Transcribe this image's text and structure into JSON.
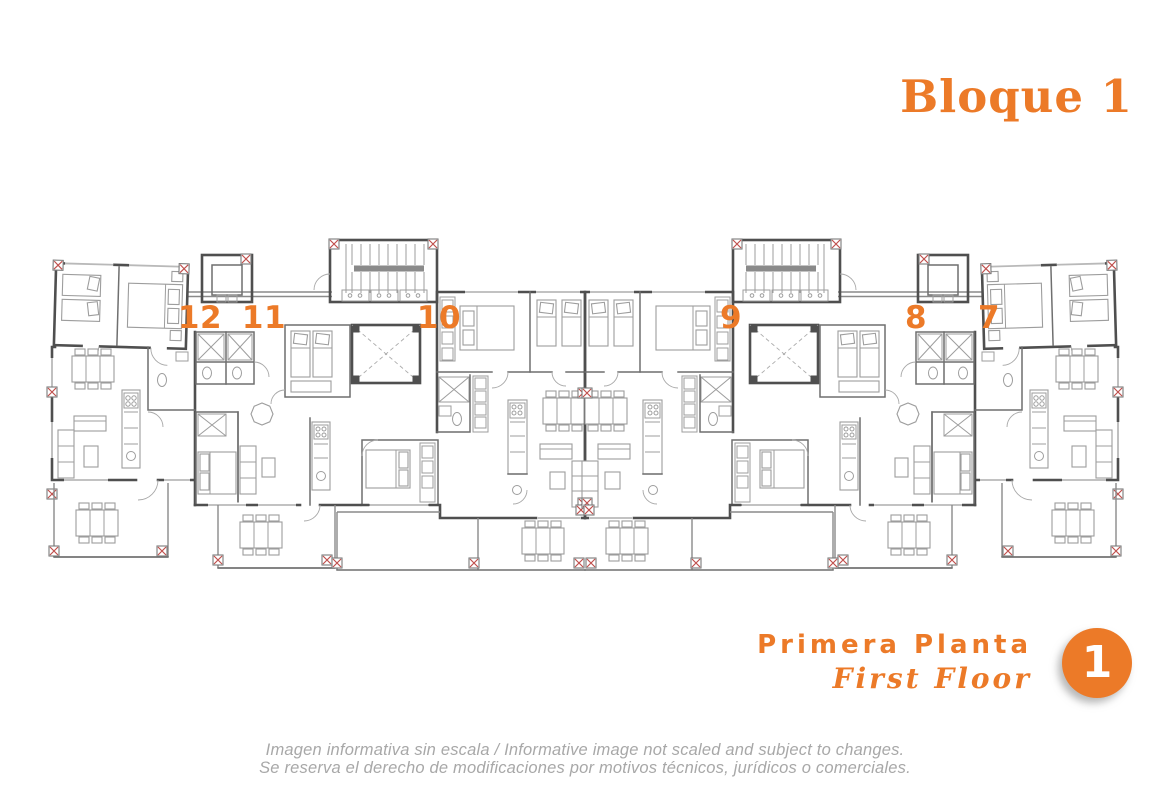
{
  "header": {
    "block_title": "Bloque 1"
  },
  "floor_plan": {
    "units": [
      {
        "number": "12"
      },
      {
        "number": "11"
      },
      {
        "number": "10"
      },
      {
        "number": "9"
      },
      {
        "number": "8"
      },
      {
        "number": "7"
      }
    ]
  },
  "footer": {
    "floor_label_es": "Primera Planta",
    "floor_label_en": "First Floor",
    "floor_number": "1",
    "disclaimer_line1": "Imagen informativa sin escala /  Informative image not scaled and subject to changes.",
    "disclaimer_line2": "Se reserva el derecho de modificaciones por motivos técnicos, jurídicos o comerciales."
  },
  "colors": {
    "accent_orange": "#EC7A28",
    "wall_gray": "#4F4F4F",
    "furniture_gray": "#9D9D9D",
    "column_marker_red": "#C0504D",
    "disclaimer_gray": "#A8A8A8"
  }
}
